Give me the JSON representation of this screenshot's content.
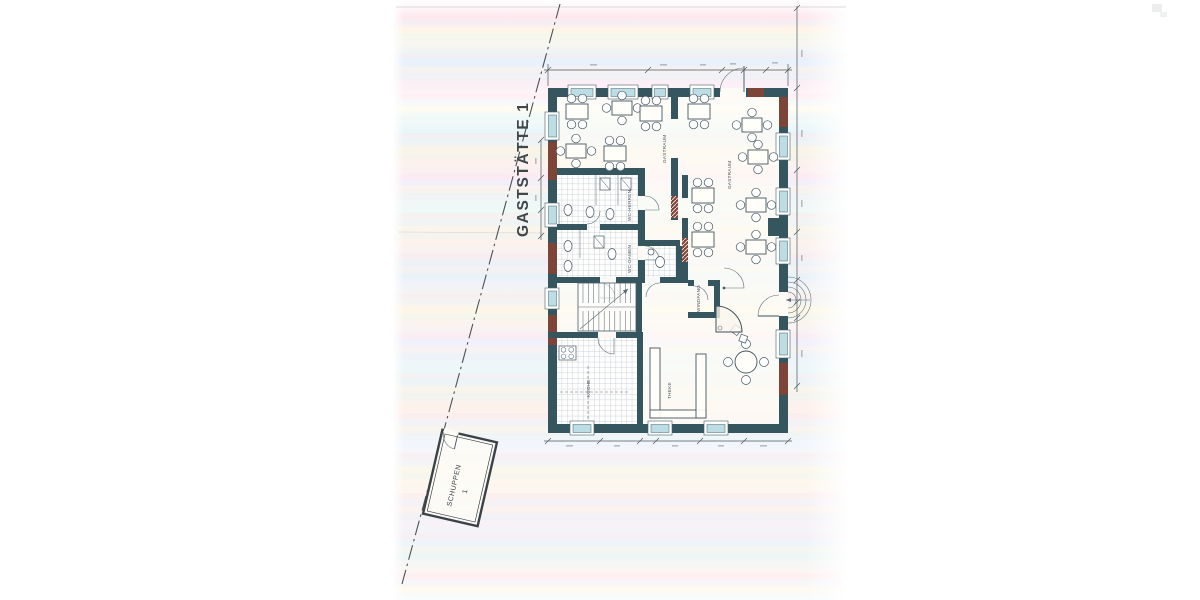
{
  "plan": {
    "title": "GASTSTÄTTE 1",
    "rooms": {
      "gastraum_left": "GASTRAUM",
      "gastraum_right": "GASTRAUM",
      "wc_herren": "WC-HERREN",
      "wc_damen": "WC-DAMEN",
      "windfang": "WINDFANG",
      "kueche": "KÜCHE",
      "theke": "THEKE"
    },
    "outbuilding": {
      "name": "SCHUPPEN",
      "number": "1"
    },
    "colors": {
      "wall": "#35565f",
      "wall_accent": "#7d4537",
      "window_glass": "#bcdde4",
      "ink": "#42525c",
      "paper": "#ffffff"
    }
  }
}
